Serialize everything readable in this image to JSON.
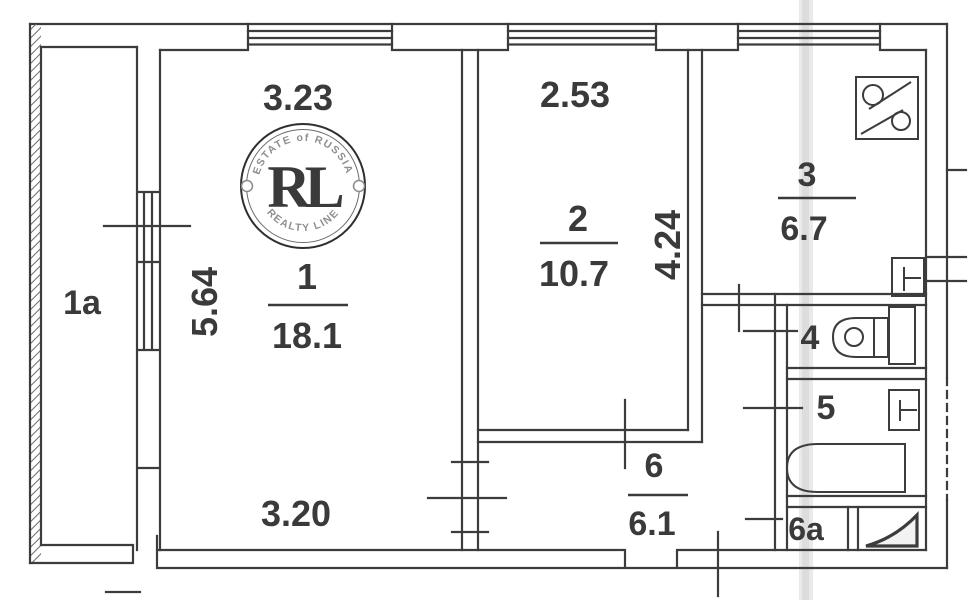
{
  "plan_title": "apartment-floor-plan",
  "colors": {
    "wall": "#3c3c3c",
    "text": "#3a3a3a",
    "scan_band": "#d8d8d8",
    "background": "#ffffff",
    "watermark_gold": "#c2973b",
    "watermark_ring": "#2f2f2f"
  },
  "rooms": {
    "balcony": {
      "label": "1a"
    },
    "living": {
      "label": "1",
      "area": "18.1"
    },
    "bedroom": {
      "label": "2",
      "area": "10.7"
    },
    "kitchen": {
      "label": "3",
      "area": "6.7"
    },
    "wc": {
      "label": "4"
    },
    "bath": {
      "label": "5"
    },
    "hall": {
      "label": "6",
      "area": "6.1"
    },
    "closet": {
      "label": "6a"
    }
  },
  "dimensions": {
    "room1_width": "3.23",
    "room1_depth": "5.64",
    "room1_bottom_width": "3.20",
    "room2_width": "2.53",
    "room2_depth": "4.24"
  },
  "watermark": {
    "arc_top": "ESTATE of RUSSIA",
    "monogram": "RL",
    "arc_bottom": "REALTY LINE"
  },
  "icons": {
    "stove": "stove-icon",
    "kitchen_sink": "sink-icon",
    "toilet": "toilet-icon",
    "wash_basin": "washbasin-icon",
    "bathtub": "bathtub-icon",
    "vent_corner": "vent-corner-icon"
  }
}
